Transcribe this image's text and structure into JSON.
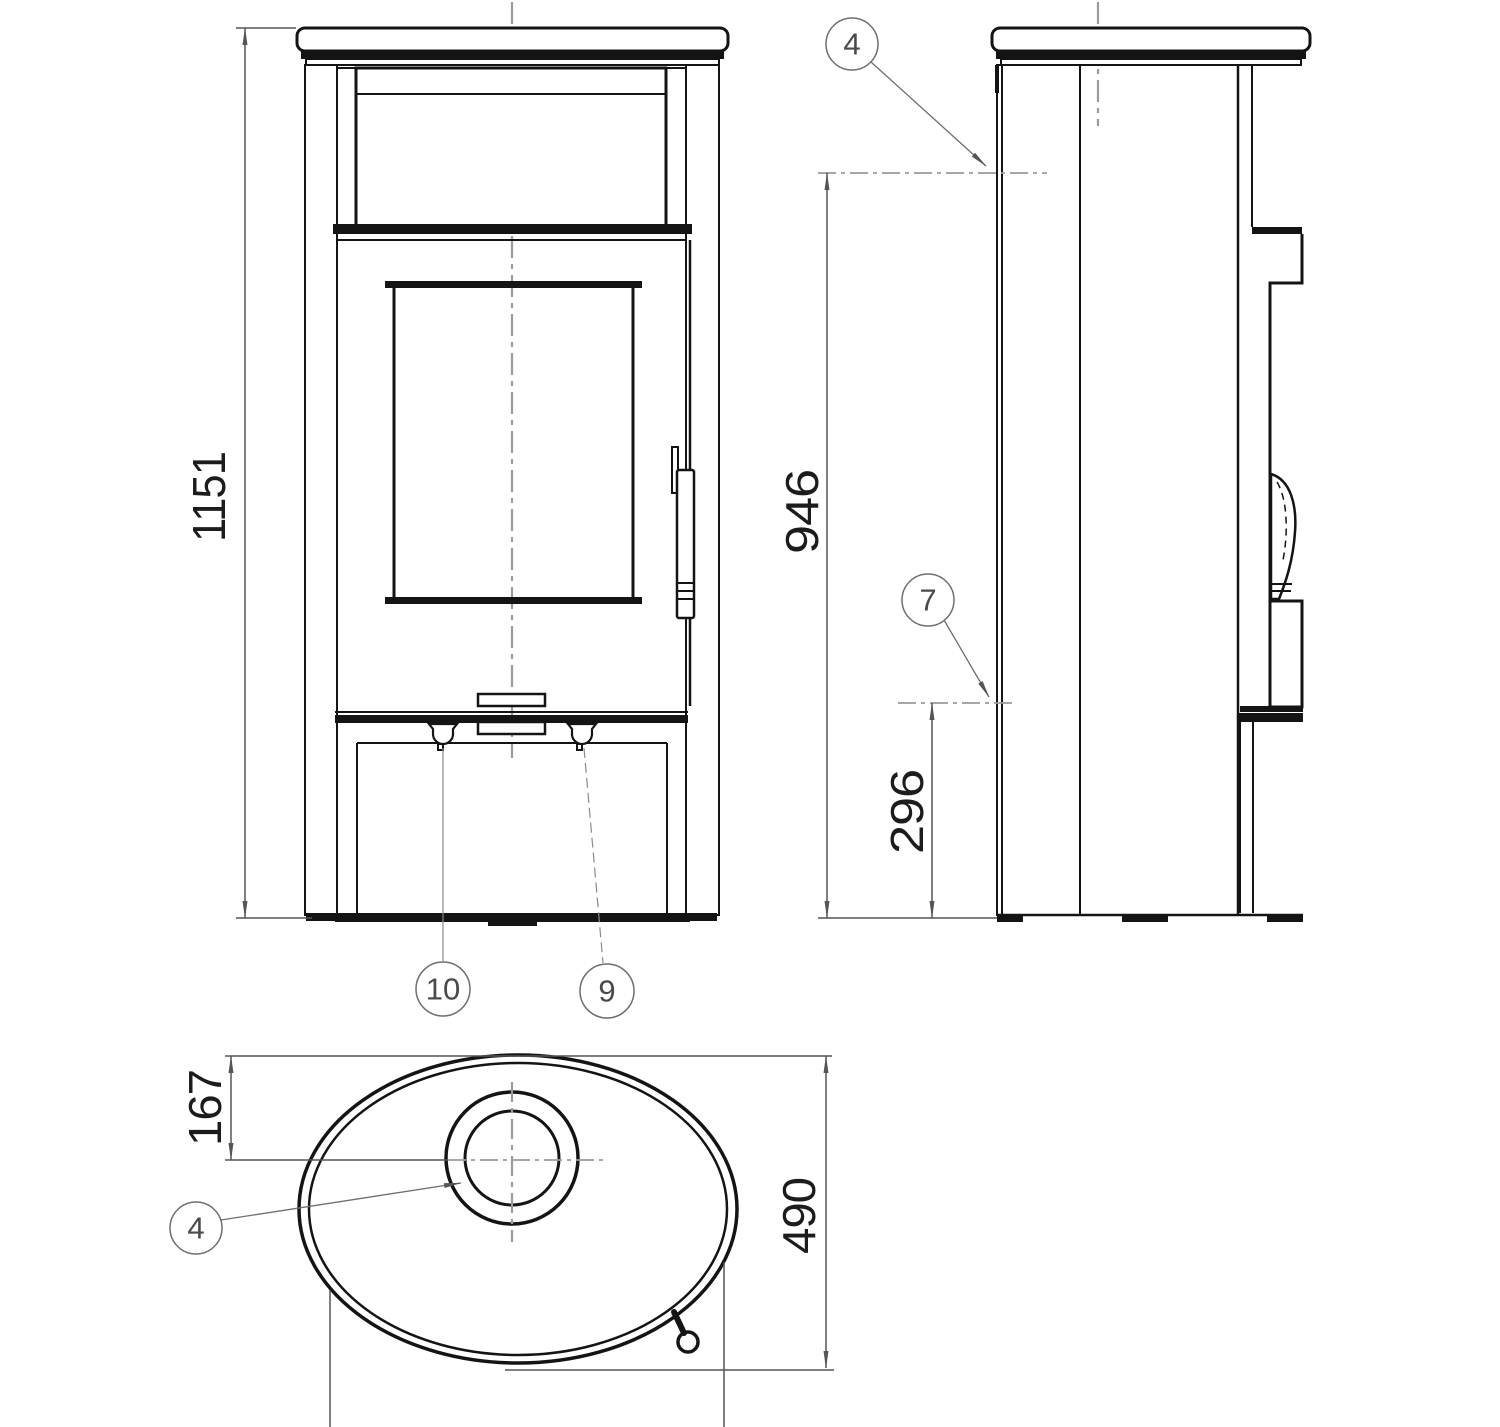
{
  "drawing": {
    "title": "stove-technical-drawing",
    "dimensions": {
      "front_height": "1151",
      "flue_height": "946",
      "lower_connector_height": "296",
      "flue_offset_from_back": "167",
      "depth": "490"
    },
    "callouts": {
      "flue_side": "4",
      "rear_connector": "7",
      "left_knob": "10",
      "right_knob": "9",
      "flue_top": "4"
    },
    "colors": {
      "line": "#141414",
      "dim_line": "#555555",
      "centerline": "#9b9b9b",
      "callout": "#6e6e6e",
      "background": "#ffffff"
    }
  }
}
